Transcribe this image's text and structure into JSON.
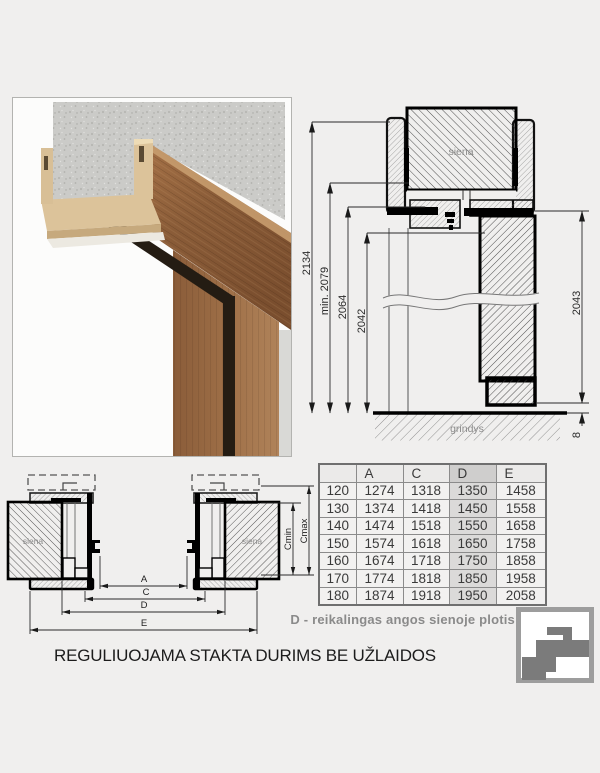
{
  "page": {
    "background": "#f0efee",
    "title": "REGULIUOJAMA STAKTA DURIMS BE UŽLAIDOS",
    "note": "D - reikalingas angos sienoje plotis"
  },
  "vertical_section": {
    "wall_label": "siena",
    "floor_label": "grindys",
    "dims": {
      "total_height": "2134",
      "min_height": "min. 2079",
      "frame_outer": "2064",
      "frame_inner": "2042",
      "door_leaf": "2043",
      "floor_gap": "8"
    }
  },
  "horizontal_section": {
    "wall_label_left": "siena",
    "wall_label_right": "siena",
    "dim_a": "A",
    "dim_c": "C",
    "dim_d": "D",
    "dim_e": "E",
    "dim_cmin": "Cmin",
    "dim_cmax": "Cmax"
  },
  "table": {
    "headers": [
      "",
      "A",
      "C",
      "D",
      "E"
    ],
    "highlighted_column": "D",
    "rows": [
      [
        "120",
        "1274",
        "1318",
        "1350",
        "1458"
      ],
      [
        "130",
        "1374",
        "1418",
        "1450",
        "1558"
      ],
      [
        "140",
        "1474",
        "1518",
        "1550",
        "1658"
      ],
      [
        "150",
        "1574",
        "1618",
        "1650",
        "1758"
      ],
      [
        "160",
        "1674",
        "1718",
        "1750",
        "1858"
      ],
      [
        "170",
        "1774",
        "1818",
        "1850",
        "1958"
      ],
      [
        "180",
        "1874",
        "1918",
        "1950",
        "2058"
      ]
    ]
  },
  "colors": {
    "table_highlight": "#dbdad9",
    "note_text": "#8a8a8a",
    "logo_gray": "#7b7b7b",
    "wood_dark": "#865936",
    "mdf_tan": "#dcc39a",
    "concrete": "#cbcbc8"
  }
}
